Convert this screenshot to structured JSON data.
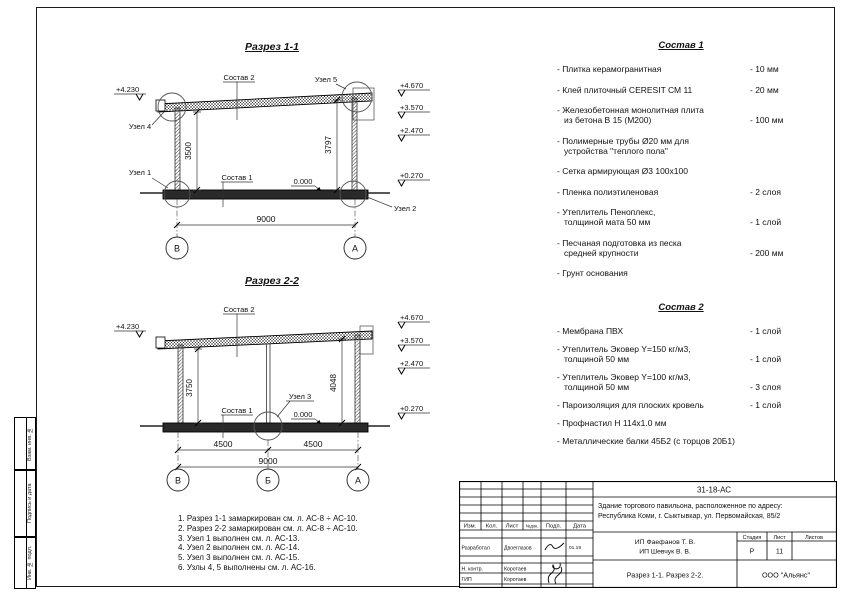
{
  "section1": {
    "title": "Разрез 1-1",
    "sostav2_label": "Состав 2",
    "sostav1_label": "Состав 1",
    "uzel1": "Узел 1",
    "uzel2": "Узел 2",
    "uzel4": "Узел 4",
    "uzel5": "Узел 5",
    "elev_left": "+4.230",
    "elev_r1": "+4.670",
    "elev_r2": "+3.570",
    "elev_r3": "+2.470",
    "elev_r4": "+0.270",
    "zero_mark": "0.000",
    "dim_left": "3500",
    "dim_right": "3797",
    "dim_total": "9000",
    "axis_left": "В",
    "axis_right": "А"
  },
  "section2": {
    "title": "Разрез 2-2",
    "sostav2_label": "Состав 2",
    "sostav1_label": "Состав 1",
    "uzel3": "Узел 3",
    "elev_left": "+4.230",
    "elev_r1": "+4.670",
    "elev_r2": "+3.570",
    "elev_r3": "+2.470",
    "elev_r4": "+0.270",
    "zero_mark": "0.000",
    "dim_left": "3750",
    "dim_right": "4048",
    "dim_span1": "4500",
    "dim_span2": "4500",
    "dim_total": "9000",
    "axis_left": "В",
    "axis_mid": "Б",
    "axis_right": "А"
  },
  "sostav1": {
    "title": "Состав 1",
    "items": [
      {
        "name": "- Плитка керамогранитная",
        "value": "- 10 мм"
      },
      {
        "name": "- Клей плиточный CERESIT СМ 11",
        "value": "- 20 мм"
      },
      {
        "name": "- Железобетонная  монолитная плита\nиз бетона В 15 (М200)",
        "value": "- 100 мм"
      },
      {
        "name": "- Полимерные трубы Ø20 мм для\nустройства \"теплого пола\"",
        "value": ""
      },
      {
        "name": "- Сетка армирующая Ø3 100х100",
        "value": ""
      },
      {
        "name": "- Пленка полиэтиленовая",
        "value": "- 2 слоя"
      },
      {
        "name": "- Утеплитель Пеноплекс,\nтолщиной мата 50 мм",
        "value": "- 1 слой"
      },
      {
        "name": "- Песчаная подготовка из песка\nсредней крупности",
        "value": "- 200 мм"
      },
      {
        "name": "- Грунт основания",
        "value": ""
      }
    ]
  },
  "sostav2": {
    "title": "Состав 2",
    "items": [
      {
        "name": "- Мембрана ПВХ",
        "value": "- 1 слой"
      },
      {
        "name": "- Утеплитель Эковер Y=150 кг/м3,\nтолщиной 50 мм",
        "value": "- 1 слой"
      },
      {
        "name": "- Утеплитель Эковер Y=100 кг/м3,\nтолщиной 50 мм",
        "value": "- 3 слоя"
      },
      {
        "name": "- Пароизоляция для плоских кровель",
        "value": "- 1 слой"
      },
      {
        "name": "- Профнастил Н 114х1.0 мм",
        "value": ""
      },
      {
        "name": "- Металлические балки 45Б2 (с торцов 20Б1)",
        "value": ""
      }
    ]
  },
  "notes": {
    "lines": [
      "1. Разрез 1-1 замаркирован см. л. АС-8 ÷ АС-10.",
      "2. Разрез 2-2 замаркирован см. л. АС-8 ÷ АС-10.",
      "3. Узел 1 выполнен см. л. АС-13.",
      "4. Узел 2 выполнен см. л. АС-14.",
      "5. Узел 3 выполнен см. л. АС-15.",
      "6. Узлы 4, 5 выполнены см. л. АС-16."
    ]
  },
  "side_stamps": {
    "box1": "Взам. инв. №",
    "box2": "Подпись и дата",
    "box3": "Инв. № подл."
  },
  "stamp": {
    "doc_number": "31-18-АС",
    "project_line1": "Здание торгового павильона, расположенное по адресу:",
    "project_line2": "Республика Коми, г. Сыктывкар, ул. Первомайская, 85/2",
    "client_line1": "ИП Фаефанов Т. В.",
    "client_line2": "ИП Шевчук В. В.",
    "col_izm": "Изм.",
    "col_kol": "Кол.",
    "col_list": "Лист",
    "col_ndok": "№док.",
    "col_podp": "Подп.",
    "col_data": "Дата",
    "row_developer_label": "Разработал",
    "row_developer_name": "Двоеглазов",
    "row_developer_date": "01.19",
    "row_ncontr_label": "Н. контр.",
    "row_ncontr_name": "Коротаев",
    "row_gip_label": "ГИП",
    "row_gip_name": "Коротаев",
    "stage_label": "Стадия",
    "sheet_label": "Лист",
    "sheets_label": "Листов",
    "stage_value": "Р",
    "sheet_value": "11",
    "sheet_title": "Разрез 1-1. Разрез 2-2.",
    "company": "ООО \"Альянс\""
  }
}
